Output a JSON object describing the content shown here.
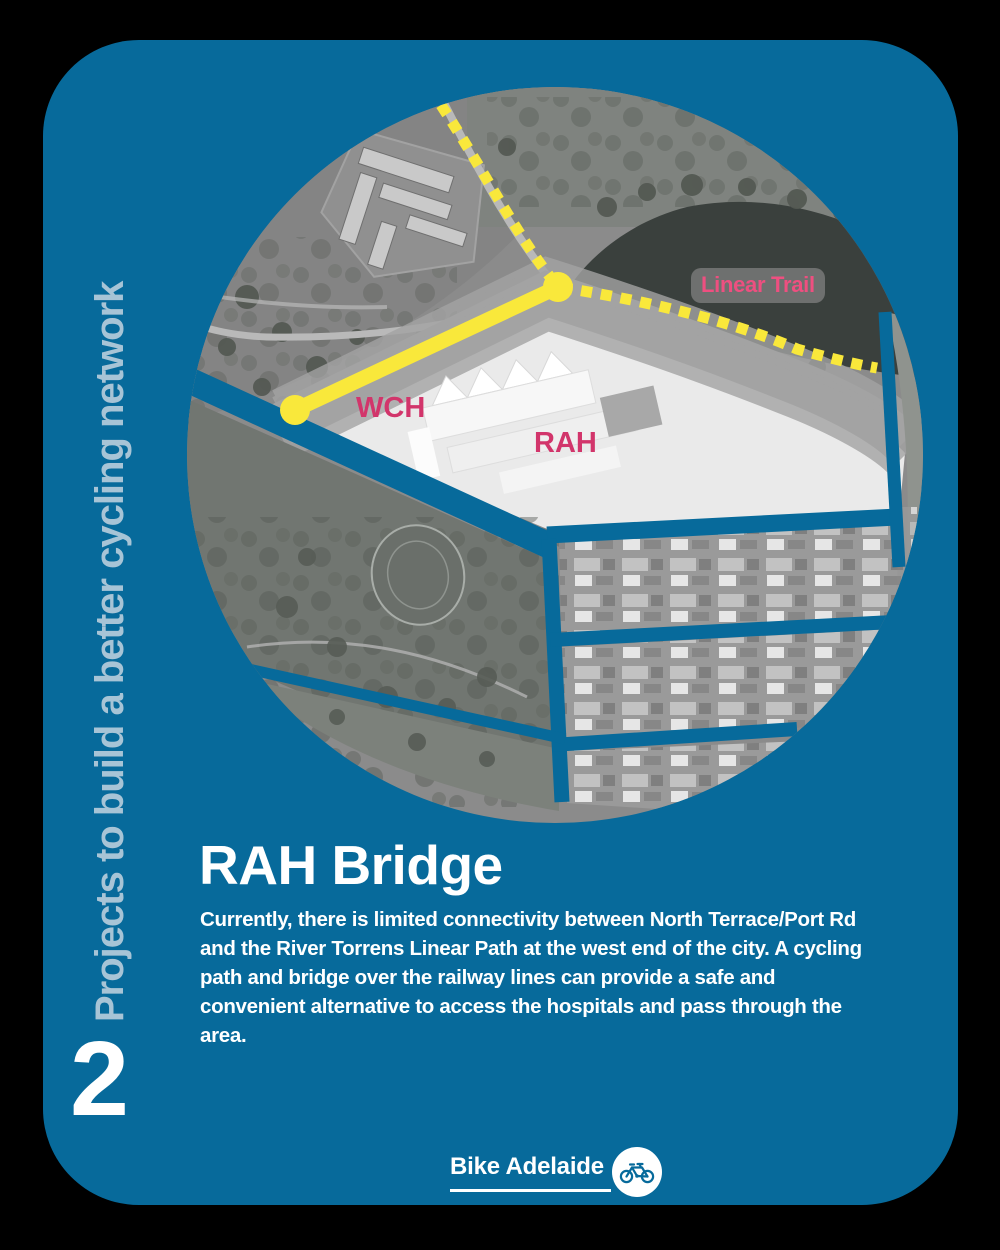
{
  "colors": {
    "teal": "#076a9b",
    "side_text": "#a7c4d6",
    "yellow": "#f9e83b",
    "pink_trail": "#ee4f80",
    "pink_map": "#d2356b"
  },
  "sidebar": {
    "vertical_label": "Projects to build a better cycling network",
    "number": "2"
  },
  "map": {
    "labels": {
      "linear_trail": "Linear Trail",
      "wch": "WCH",
      "rah": "RAH"
    }
  },
  "content": {
    "title": "RAH Bridge",
    "body_lines": [
      "Currently, there is limited connectivity between North Terrace/Port Rd",
      "and the River Torrens Linear Path at the west end of the city. A cycling",
      "path and bridge over the railway lines can provide a safe and",
      "convenient alternative to access the hospitals and pass through the",
      "area."
    ]
  },
  "footer": {
    "brand": "Bike Adelaide"
  }
}
